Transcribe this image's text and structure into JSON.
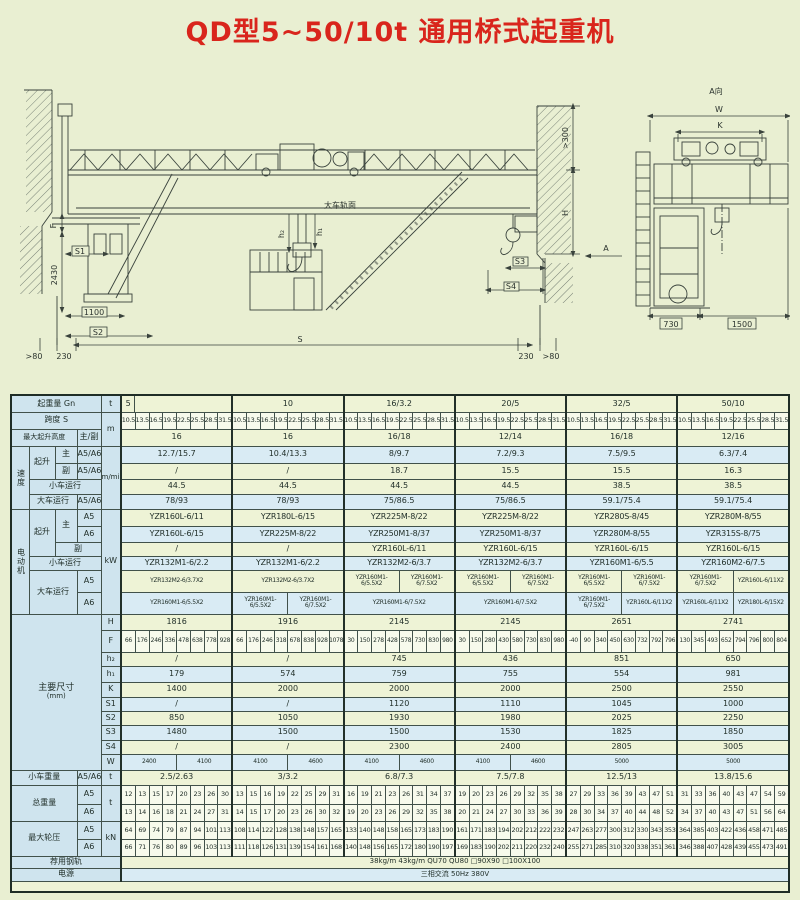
{
  "title": "QD型5~50/10t 通用桥式起重机",
  "drawing": {
    "labels": {
      "a_view": "A向",
      "a": "A",
      "w": "W",
      "k": "K",
      "d730": "730",
      "d1500": "1500",
      "gt300": ">300",
      "h": "H",
      "s3": "S3",
      "s4": "S4",
      "d230r": "230",
      "gt80r": ">80",
      "rail_top": "大车轨面",
      "h1": "h₁",
      "h2": "h₂",
      "f": "F",
      "d2430": "2430",
      "s1": "S1",
      "d1100": "1100",
      "s2": "S2",
      "gt80l": ">80",
      "d230l": "230",
      "s": "S"
    }
  },
  "table": {
    "labels": {
      "capacity": "起重量 Gn",
      "span": "跨度 S",
      "lift_height": "最大起升高度",
      "main_aux": "主/副",
      "speed": "速度",
      "hoist": "起升",
      "main": "主",
      "aux": "副",
      "a56": "A5/A6",
      "a5": "A5",
      "a6": "A6",
      "trolley_travel": "小车运行",
      "bridge_travel": "大车运行",
      "motor": "电动机",
      "dims": "主要尺寸",
      "mm": "(mm)",
      "dim_rows": [
        "H",
        "F",
        "h₂",
        "h₁",
        "K",
        "S1",
        "S2",
        "S3",
        "S4",
        "W"
      ],
      "trolley_weight": "小车重量",
      "total_weight": "总重量",
      "wheel_load": "最大轮压",
      "rail": "荐用钢轨",
      "power": "电源",
      "unit_t": "t",
      "unit_m": "m",
      "unit_mmin": "m/min",
      "unit_kw": "kW",
      "unit_kn": "kN"
    },
    "capacities": [
      "5",
      "10",
      "16/3.2",
      "20/5",
      "32/5",
      "50/10"
    ],
    "span_values": [
      "10.5",
      "13.5",
      "16.5",
      "19.5",
      "22.5",
      "25.5",
      "28.5",
      "31.5"
    ],
    "lift_height": [
      "16",
      "16",
      "16/18",
      "12/14",
      "16/18",
      "12/16"
    ],
    "speed_main": [
      "12.7/15.7",
      "10.4/13.3",
      "8/9.7",
      "7.2/9.3",
      "7.5/9.5",
      "6.3/7.4"
    ],
    "speed_aux": [
      "/",
      "/",
      "18.7",
      "15.5",
      "15.5",
      "16.3"
    ],
    "speed_trolley": [
      "44.5",
      "44.5",
      "44.5",
      "44.5",
      "38.5",
      "38.5"
    ],
    "speed_bridge": [
      "78/93",
      "78/93",
      "75/86.5",
      "75/86.5",
      "59.1/75.4",
      "59.1/75.4"
    ],
    "motor_main_a5": [
      "YZR160L-6/11",
      "YZR180L-6/15",
      "YZR225M-8/22",
      "YZR225M-8/22",
      "YZR280S-8/45",
      "YZR280M-8/55"
    ],
    "motor_main_a6": [
      "YZR160L-6/15",
      "YZR225M-8/22",
      "YZR250M1-8/37",
      "YZR250M1-8/37",
      "YZR280M-8/55",
      "YZR315S-8/75"
    ],
    "motor_aux": [
      "/",
      "/",
      "YZR160L-6/11",
      "YZR160L-6/15",
      "YZR160L-6/15",
      "YZR160L-6/15"
    ],
    "motor_trolley": [
      "YZR132M1-6/2.2",
      "YZR132M1-6/2.2",
      "YZR132M2-6/3.7",
      "YZR132M2-6/3.7",
      "YZR160M1-6/5.5",
      "YZR160M2-6/7.5"
    ],
    "motor_bridge_a5": [
      [
        "YZR132M2-6/3.7X2"
      ],
      [
        "YZR132M2-6/3.7X2"
      ],
      [
        "YZR160M1-6/5.5X2",
        "YZR160M1-6/7.5X2"
      ],
      [
        "YZR160M1-6/5.5X2",
        "YZR160M1-6/7.5X2"
      ],
      [
        "YZR160M1-6/5.5X2",
        "YZR160M1-6/7.5X2"
      ],
      [
        "YZR160M1-6/7.5X2",
        "YZR160L-6/11X2"
      ]
    ],
    "motor_bridge_a6": [
      [
        "YZR160M1-6/5.5X2"
      ],
      [
        "YZR160M1-6/5.5X2",
        "YZR160M1-6/7.5X2"
      ],
      [
        "YZR160M1-6/7.5X2"
      ],
      [
        "YZR160M1-6/7.5X2"
      ],
      [
        "YZR160M1-6/7.5X2",
        "YZR160L-6/11X2"
      ],
      [
        "YZR160L-6/11X2",
        "YZR180L-6/15X2"
      ]
    ],
    "dim_H": [
      "1816",
      "1916",
      "2145",
      "2145",
      "2651",
      "2741"
    ],
    "dim_F": [
      [
        "66",
        "176",
        "246",
        "336",
        "478",
        "638",
        "778",
        "928"
      ],
      [
        "66",
        "176",
        "246",
        "318",
        "678",
        "838",
        "928",
        "1078"
      ],
      [
        "30",
        "150",
        "278",
        "428",
        "578",
        "730",
        "830",
        "980"
      ],
      [
        "30",
        "150",
        "280",
        "430",
        "580",
        "730",
        "830",
        "980"
      ],
      [
        "-40",
        "90",
        "340",
        "450",
        "630",
        "732",
        "792",
        "796"
      ],
      [
        "130",
        "345",
        "493",
        "652",
        "794",
        "796",
        "800",
        "804"
      ]
    ],
    "dim_h2": [
      "/",
      "/",
      "745",
      "436",
      "851",
      "650"
    ],
    "dim_h1": [
      "179",
      "574",
      "759",
      "755",
      "554",
      "981"
    ],
    "dim_K": [
      "1400",
      "2000",
      "2000",
      "2000",
      "2500",
      "2550"
    ],
    "dim_S1": [
      "/",
      "/",
      "1120",
      "1110",
      "1045",
      "1000"
    ],
    "dim_S2": [
      "850",
      "1050",
      "1930",
      "1980",
      "2025",
      "2250"
    ],
    "dim_S3": [
      "1480",
      "1500",
      "1500",
      "1530",
      "1825",
      "1850"
    ],
    "dim_S4": [
      "/",
      "/",
      "2300",
      "2400",
      "2805",
      "3005"
    ],
    "dim_W": [
      [
        "2400",
        "4100"
      ],
      [
        "4100",
        "4600"
      ],
      [
        "4100",
        "4600"
      ],
      [
        "4100",
        "4600"
      ],
      [
        "5000"
      ],
      [
        "5000"
      ]
    ],
    "trolley_weight": [
      "2.5/2.63",
      "3/3.2",
      "6.8/7.3",
      "7.5/7.8",
      "12.5/13",
      "13.8/15.6"
    ],
    "total_a5": [
      [
        "12",
        "13",
        "15",
        "17",
        "20",
        "23",
        "26",
        "30"
      ],
      [
        "13",
        "15",
        "16",
        "19",
        "22",
        "25",
        "29",
        "31"
      ],
      [
        "16",
        "19",
        "21",
        "23",
        "26",
        "31",
        "34",
        "37"
      ],
      [
        "19",
        "20",
        "23",
        "26",
        "29",
        "32",
        "35",
        "38"
      ],
      [
        "27",
        "29",
        "33",
        "36",
        "39",
        "43",
        "47",
        "51"
      ],
      [
        "31",
        "33",
        "36",
        "40",
        "43",
        "47",
        "54",
        "59"
      ]
    ],
    "total_a6": [
      [
        "13",
        "14",
        "16",
        "18",
        "21",
        "24",
        "27",
        "31"
      ],
      [
        "14",
        "15",
        "17",
        "20",
        "23",
        "26",
        "30",
        "32"
      ],
      [
        "19",
        "20",
        "23",
        "26",
        "29",
        "32",
        "35",
        "38"
      ],
      [
        "20",
        "21",
        "24",
        "27",
        "30",
        "33",
        "36",
        "39"
      ],
      [
        "28",
        "30",
        "34",
        "37",
        "40",
        "44",
        "48",
        "52"
      ],
      [
        "34",
        "37",
        "40",
        "43",
        "47",
        "51",
        "56",
        "64"
      ]
    ],
    "wheel_a5": [
      [
        "64",
        "69",
        "74",
        "79",
        "87",
        "94",
        "101",
        "113"
      ],
      [
        "108",
        "114",
        "122",
        "128",
        "138",
        "148",
        "157",
        "165"
      ],
      [
        "133",
        "140",
        "148",
        "158",
        "165",
        "173",
        "183",
        "190"
      ],
      [
        "161",
        "171",
        "183",
        "194",
        "202",
        "212",
        "222",
        "232"
      ],
      [
        "247",
        "263",
        "277",
        "300",
        "312",
        "330",
        "343",
        "353"
      ],
      [
        "364",
        "385",
        "403",
        "422",
        "436",
        "458",
        "471",
        "485"
      ]
    ],
    "wheel_a6": [
      [
        "66",
        "71",
        "76",
        "80",
        "89",
        "96",
        "103",
        "113"
      ],
      [
        "111",
        "118",
        "126",
        "131",
        "139",
        "154",
        "161",
        "168"
      ],
      [
        "140",
        "148",
        "156",
        "165",
        "172",
        "180",
        "190",
        "197"
      ],
      [
        "169",
        "183",
        "190",
        "202",
        "211",
        "220",
        "232",
        "240"
      ],
      [
        "255",
        "271",
        "285",
        "310",
        "320",
        "338",
        "351",
        "361"
      ],
      [
        "346",
        "388",
        "407",
        "428",
        "439",
        "455",
        "473",
        "491"
      ]
    ],
    "rail_text": "38kg/m   43kg/m   QU70   QU80   □90X90   □100X100",
    "power_text": "三相交流   50Hz   380V"
  }
}
